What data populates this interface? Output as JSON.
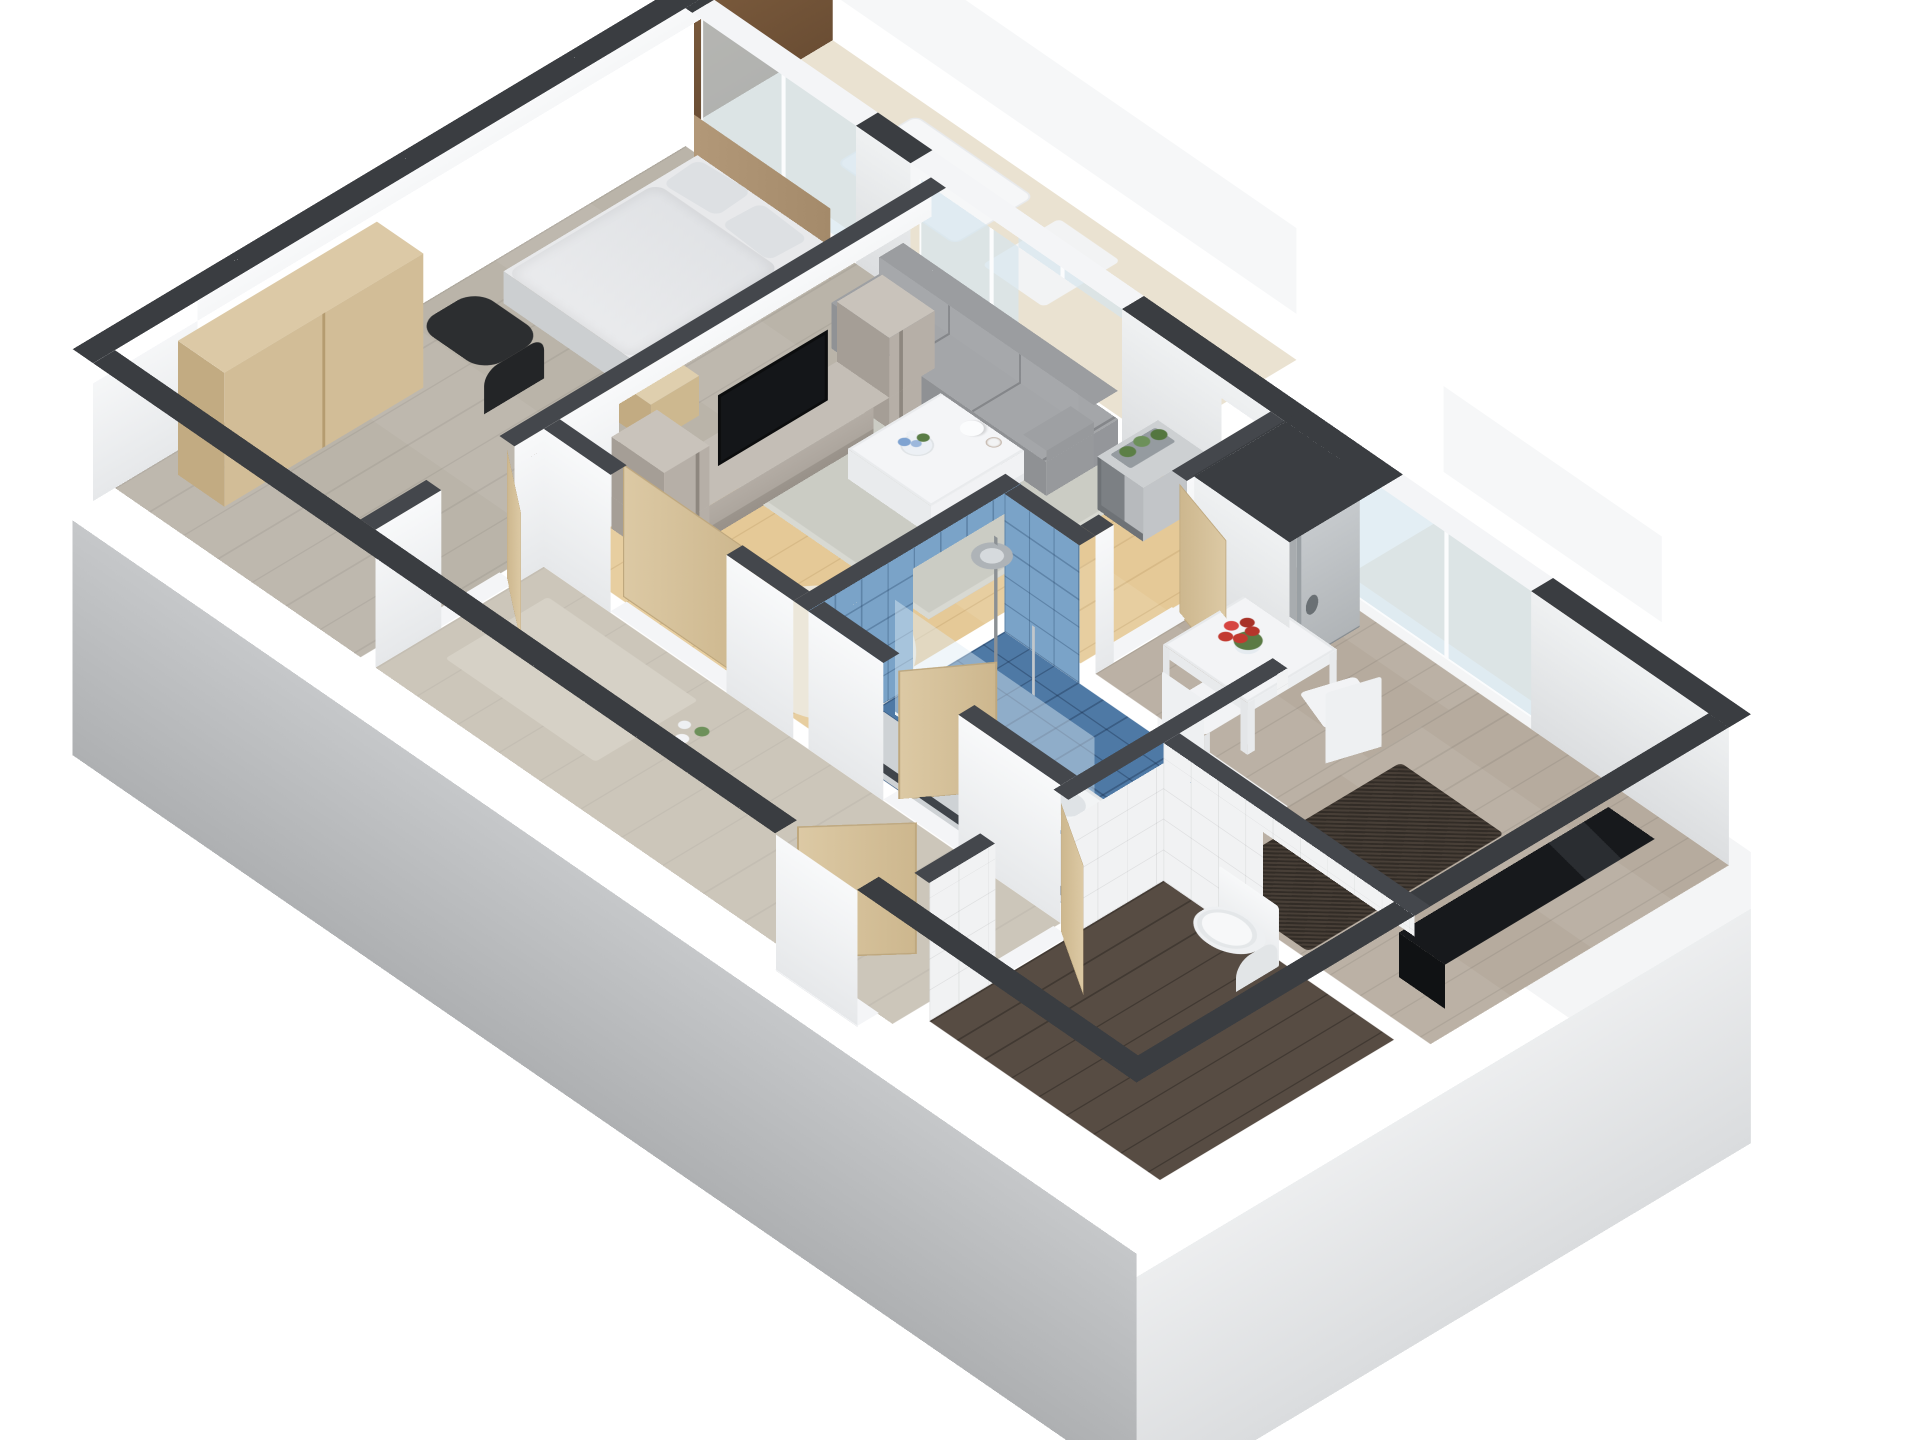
{
  "scene": {
    "type": "isometric-3d-floor-plan",
    "title": "3D cutaway floor plan of a one-bedroom apartment",
    "view": "axonometric bird's-eye view from the south-west, white background",
    "background_color": "#ffffff",
    "wall_cut_color": "#3a3d41",
    "exterior_wall_color": "#c9cbcd"
  },
  "rooms": [
    {
      "name": "Bedroom",
      "floor_finish": "grey oak planks",
      "items": [
        "double bed with wooden headboard",
        "two pillows",
        "wardrobe",
        "nightstand with vase",
        "dark armchair",
        "framed picture on wall",
        "window behind bed"
      ]
    },
    {
      "name": "Living room",
      "floor_finish": "light oak planks",
      "items": [
        "TV wall unit",
        "flat-screen TV",
        "grey sofa",
        "white coffee table",
        "flower vase",
        "teapot and cup",
        "grey area rug",
        "cowhide rug",
        "corner shelf with herb planter",
        "large window to balcony",
        "sliding door to hallway"
      ]
    },
    {
      "name": "Kitchen / dining",
      "floor_finish": "grey wood planks",
      "items": [
        "white dining table",
        "red tulip bouquet",
        "two white chairs",
        "stainless fridge freezer in niche",
        "dark runner mat",
        "black countertop",
        "window to balcony"
      ]
    },
    {
      "name": "Hallway",
      "floor_finish": "beige screed",
      "items": [
        "entrance door",
        "door to bedroom",
        "door to shower room",
        "door to WC",
        "white orchid decoration"
      ]
    },
    {
      "name": "Shower room",
      "floor_finish": "blue mosaic tiles",
      "items": [
        "walk-in rain shower",
        "glass shower screen",
        "hand shower",
        "washbasin cabinet"
      ]
    },
    {
      "name": "WC",
      "floor_finish": "dark wood planks",
      "items": [
        "close-coupled toilet",
        "white tiled walls"
      ]
    },
    {
      "name": "Balcony",
      "floor_finish": "beige decking",
      "items": [
        "white railing",
        "brown privacy screen",
        "white lounger"
      ]
    }
  ],
  "palette": {
    "wall_top": "#3a3d41",
    "interior_wall": "#f6f7f8",
    "bedroom_floor": "#bab4a9",
    "living_floor": "#e5c997",
    "kitchen_floor": "#b6ab9e",
    "hall_floor": "#ccc6ba",
    "wc_floor": "#574c43",
    "shower_tile": "#4e79a5",
    "white_tile": "#f1f2f3",
    "door_wood": "#d8c59f",
    "wardrobe_wood": "#d2bd97",
    "tv_unit": "#b3aca4",
    "tv_screen": "#141619",
    "sofa": "#9b9da0",
    "rug": "#cbccc4",
    "cowhide": "#ece7da",
    "coffee_table": "#f4f5f7",
    "dining_set": "#f2f3f5",
    "tulips": "#c23a30",
    "fridge": "#bcc0c4",
    "mat": "#483f37",
    "counter": "#17191c",
    "sanitary": "#f7f8f9",
    "glass": "#d5e5ee",
    "balcony_floor": "#eae2d1",
    "privacy_screen": "#7a5a3c"
  }
}
